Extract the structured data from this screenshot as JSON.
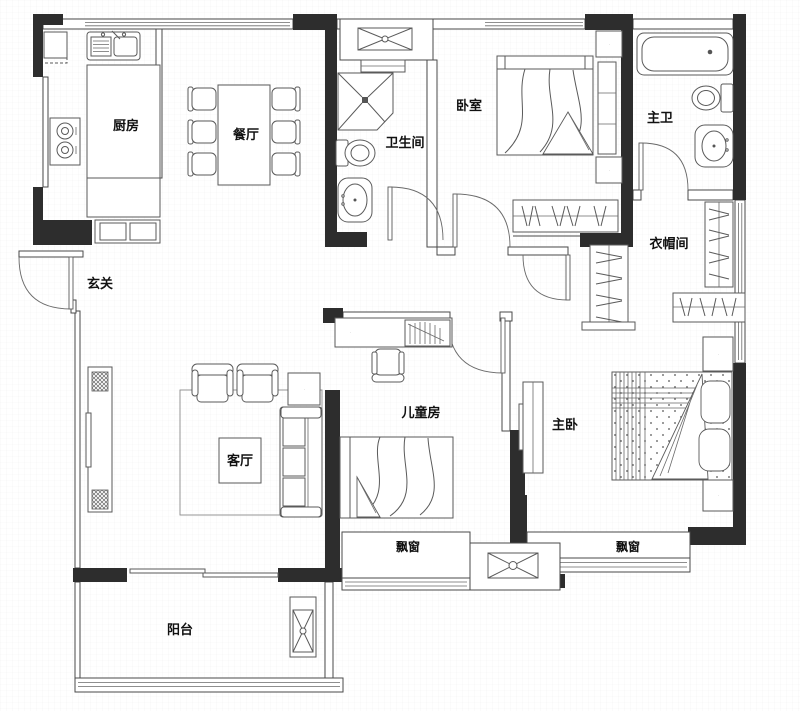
{
  "canvas": {
    "width": 800,
    "height": 711,
    "background": "#ffffff"
  },
  "colors": {
    "wall_line": "#4a4a4a",
    "shear_wall_fill": "#2d2d2d",
    "furniture_line": "#5a5a5a",
    "label_text": "#111111",
    "grid_line": "#f1f1f1"
  },
  "rooms": {
    "kitchen": {
      "label": "厨房"
    },
    "dining": {
      "label": "餐厅"
    },
    "bathroom": {
      "label": "卫生间"
    },
    "bedroom": {
      "label": "卧室"
    },
    "master_bath": {
      "label": "主卫"
    },
    "closet": {
      "label": "衣帽间"
    },
    "entry": {
      "label": "玄关"
    },
    "living": {
      "label": "客厅"
    },
    "kids_room": {
      "label": "儿童房"
    },
    "master_bedroom": {
      "label": "主卧"
    },
    "bay_window_left": {
      "label": "飘窗"
    },
    "bay_window_right": {
      "label": "飘窗"
    },
    "balcony": {
      "label": "阳台"
    }
  },
  "furniture_icons": [
    "fridge-icon",
    "kitchen-sink-icon",
    "gas-stove-icon",
    "kitchen-island-icon",
    "dining-table-icon",
    "dining-chair-icon",
    "vent-shaft-icon",
    "shower-icon",
    "toilet-icon",
    "washbasin-icon",
    "bathtub-icon",
    "double-bed-icon",
    "single-bed-icon",
    "nightstand-lamp-icon",
    "wardrobe-icon",
    "sofa-icon",
    "armchair-icon",
    "side-table-lamp-icon",
    "tv-cabinet-icon",
    "speaker-icon",
    "coffee-table-icon",
    "desk-icon",
    "desk-chair-icon",
    "bookshelf-icon",
    "ac-unit-icon",
    "sliding-door-icon",
    "door-swing-icon",
    "bay-window-icon"
  ]
}
